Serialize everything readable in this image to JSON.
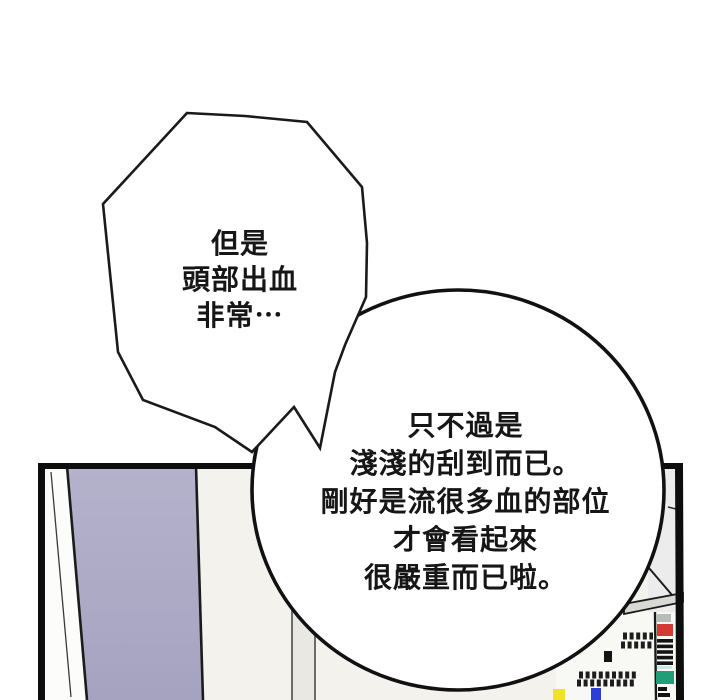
{
  "page": {
    "type": "comic-panel-page",
    "background": "#ffffff"
  },
  "speech_bubbles": {
    "spiky": {
      "lines": [
        "但是",
        "頭部出血",
        "非常⋯"
      ]
    },
    "round": {
      "lines": [
        "只不過是",
        "淺淺的刮到而已。",
        "剛好是流很多血的部位",
        "才會看起來",
        "很嚴重而已啦。"
      ]
    }
  },
  "colors": {
    "ink": "#1a1a1a",
    "door_lavender": "#a9a7c4",
    "door_lavender_light": "#b4b2cb",
    "wall_cream": "#f3f2ed",
    "wall_shadow": "#e9e8e3",
    "corner_gray": "#ececec",
    "shelf_band_gray": "#d8d8d5",
    "book_red": "#d23b33",
    "book_teal": "#1f9e77",
    "book_gray": "#b9bdb9",
    "book_lightblue": "#cfe3ea",
    "book_yellow": "#f2e224",
    "book_blue": "#2b3fd8"
  }
}
